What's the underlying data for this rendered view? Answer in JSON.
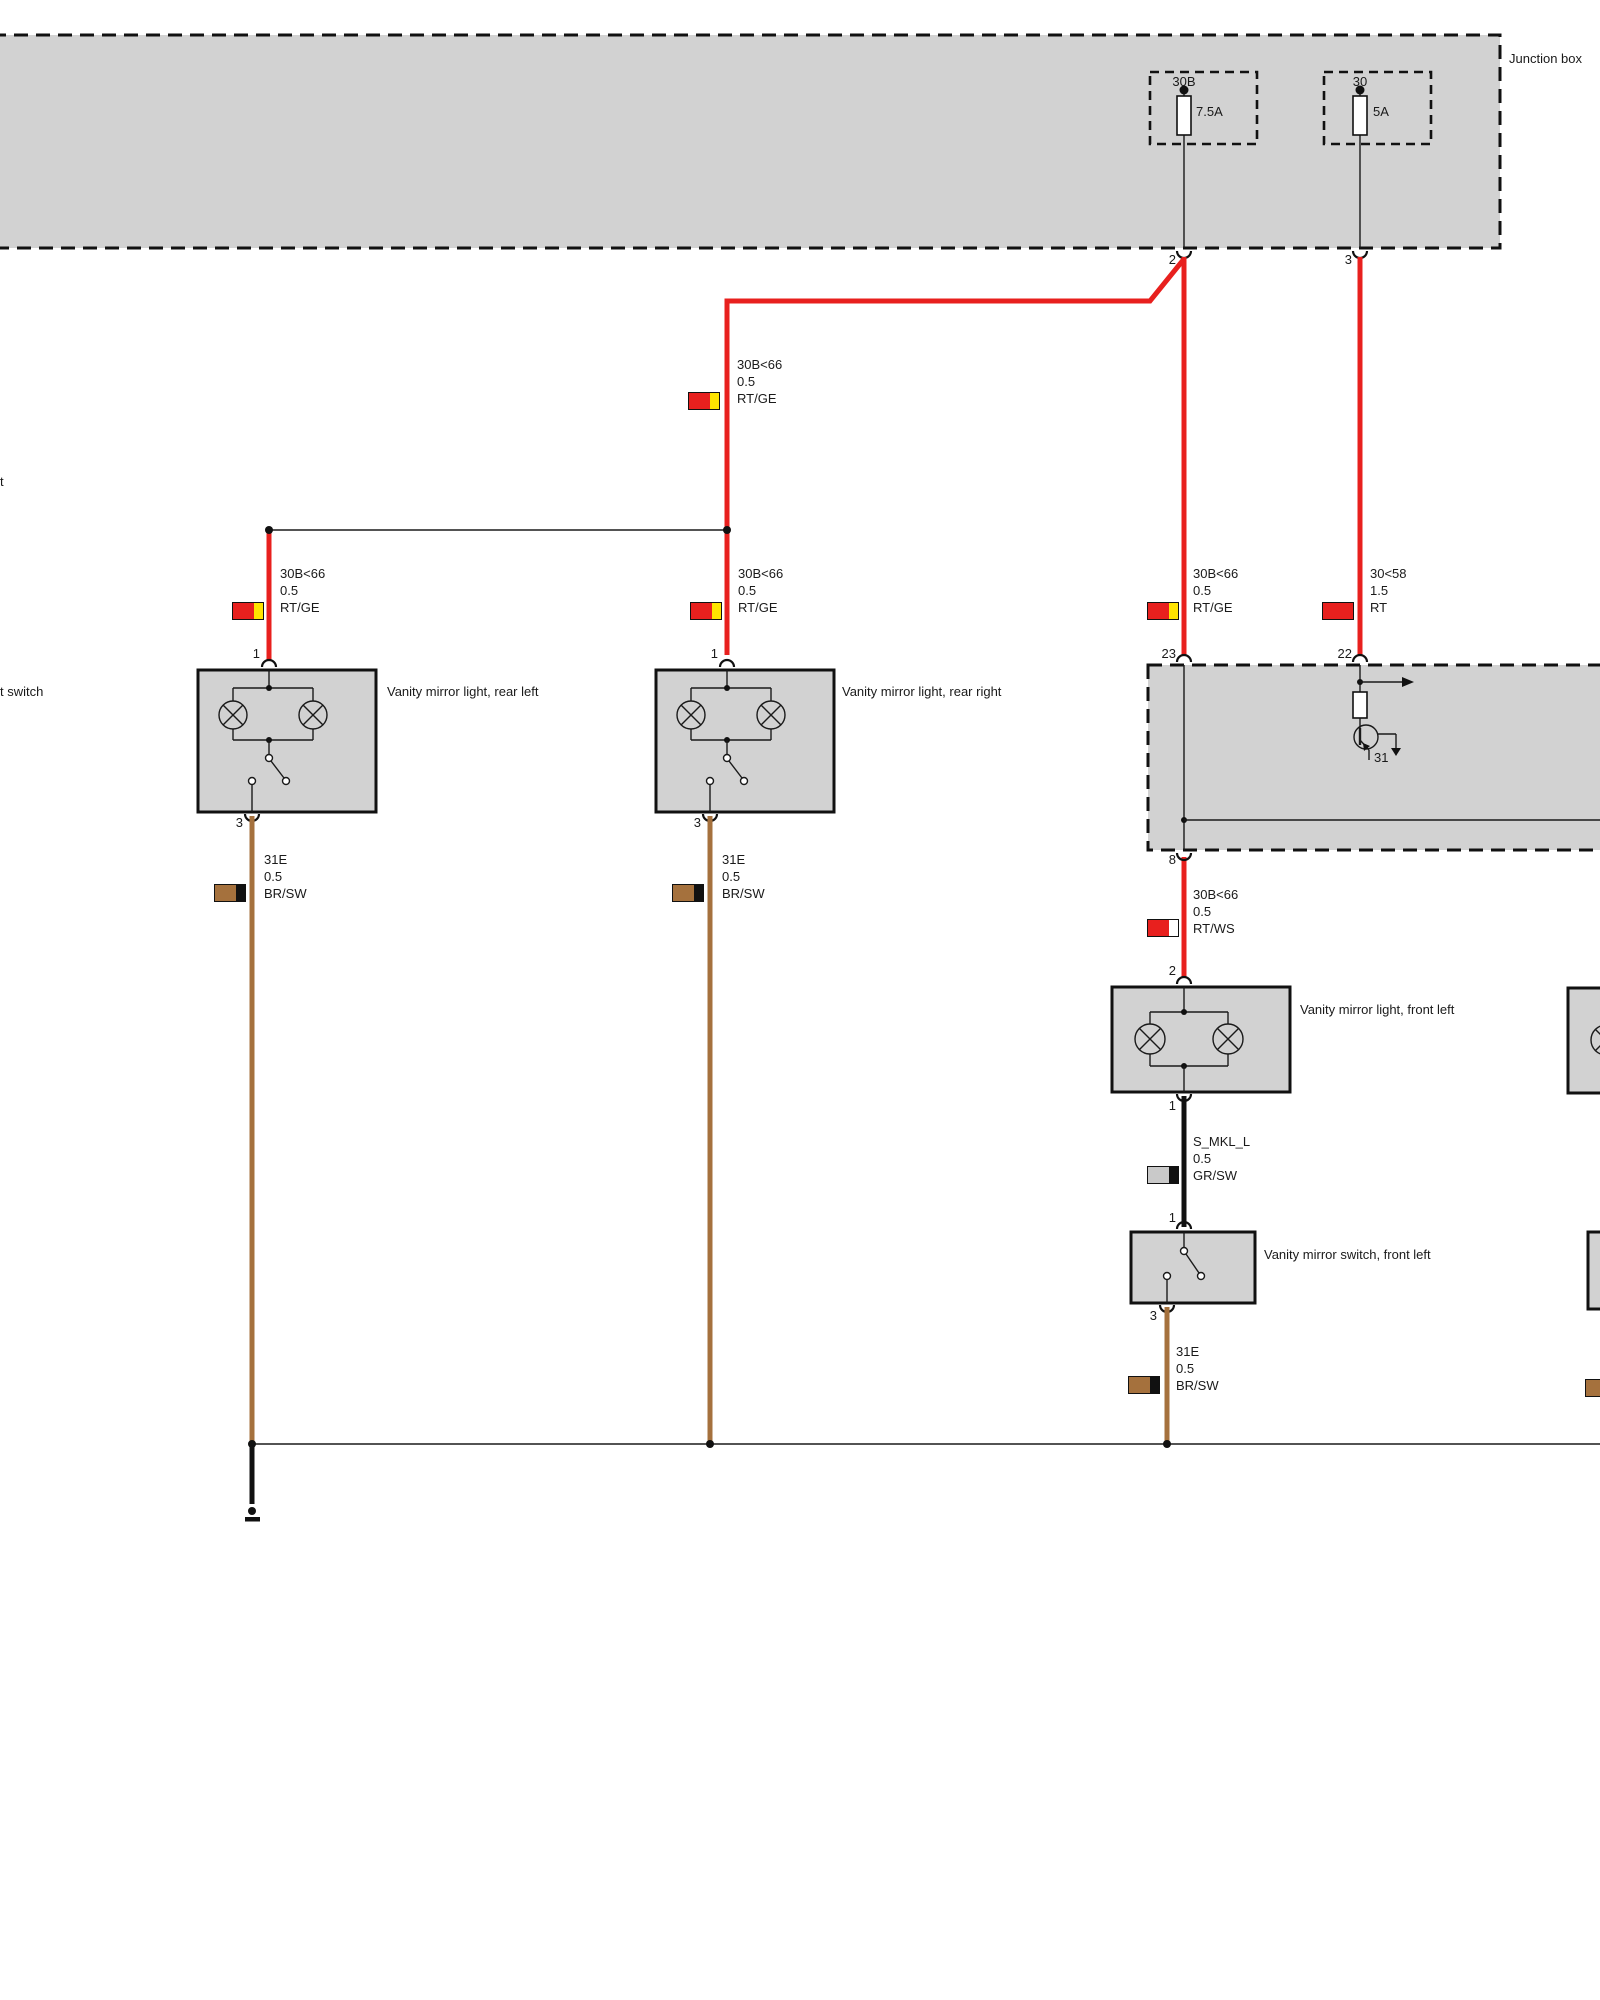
{
  "junction_box": {
    "label": "Junction box",
    "fuses": [
      {
        "id": "30B",
        "rating": "7.5A"
      },
      {
        "id": "30",
        "rating": "5A"
      }
    ],
    "pins": {
      "out_left": "2",
      "out_right": "3"
    }
  },
  "module": {
    "pins": {
      "p23": "23",
      "p22": "22",
      "p8": "8"
    },
    "internal_ground": "31"
  },
  "components": {
    "rear_left_light": {
      "label": "Vanity mirror light, rear left",
      "pin_top": "1",
      "pin_bottom": "3"
    },
    "rear_right_light": {
      "label": "Vanity mirror light, rear right",
      "pin_top": "1",
      "pin_bottom": "3"
    },
    "front_left_light": {
      "label": "Vanity mirror light, front left",
      "pin_top": "2",
      "pin_bottom": "1"
    },
    "front_left_switch": {
      "label": "Vanity mirror switch, front left",
      "pin_top": "1",
      "pin_bottom": "3"
    }
  },
  "wire_labels": {
    "feed_top": {
      "circuit": "30B<66",
      "size": "0.5",
      "color": "RT/GE"
    },
    "rear_left": {
      "circuit": "30B<66",
      "size": "0.5",
      "color": "RT/GE"
    },
    "rear_right": {
      "circuit": "30B<66",
      "size": "0.5",
      "color": "RT/GE"
    },
    "module_23": {
      "circuit": "30B<66",
      "size": "0.5",
      "color": "RT/GE"
    },
    "module_22": {
      "circuit": "30<58",
      "size": "1.5",
      "color": "RT"
    },
    "front_feed": {
      "circuit": "30B<66",
      "size": "0.5",
      "color": "RT/WS"
    },
    "switch_signal": {
      "circuit": "S_MKL_L",
      "size": "0.5",
      "color": "GR/SW"
    },
    "ground_rear_left": {
      "circuit": "31E",
      "size": "0.5",
      "color": "BR/SW"
    },
    "ground_rear_right": {
      "circuit": "31E",
      "size": "0.5",
      "color": "BR/SW"
    },
    "ground_front_left": {
      "circuit": "31E",
      "size": "0.5",
      "color": "BR/SW"
    }
  },
  "edge_labels": {
    "left_clipped_1": "t",
    "left_clipped_2": "t switch"
  },
  "colors": {
    "wire_red": "#e8201e",
    "wire_brown": "#a5713d",
    "swatch_yellow": "#ffe400",
    "box_fill": "#d2d2d2"
  }
}
